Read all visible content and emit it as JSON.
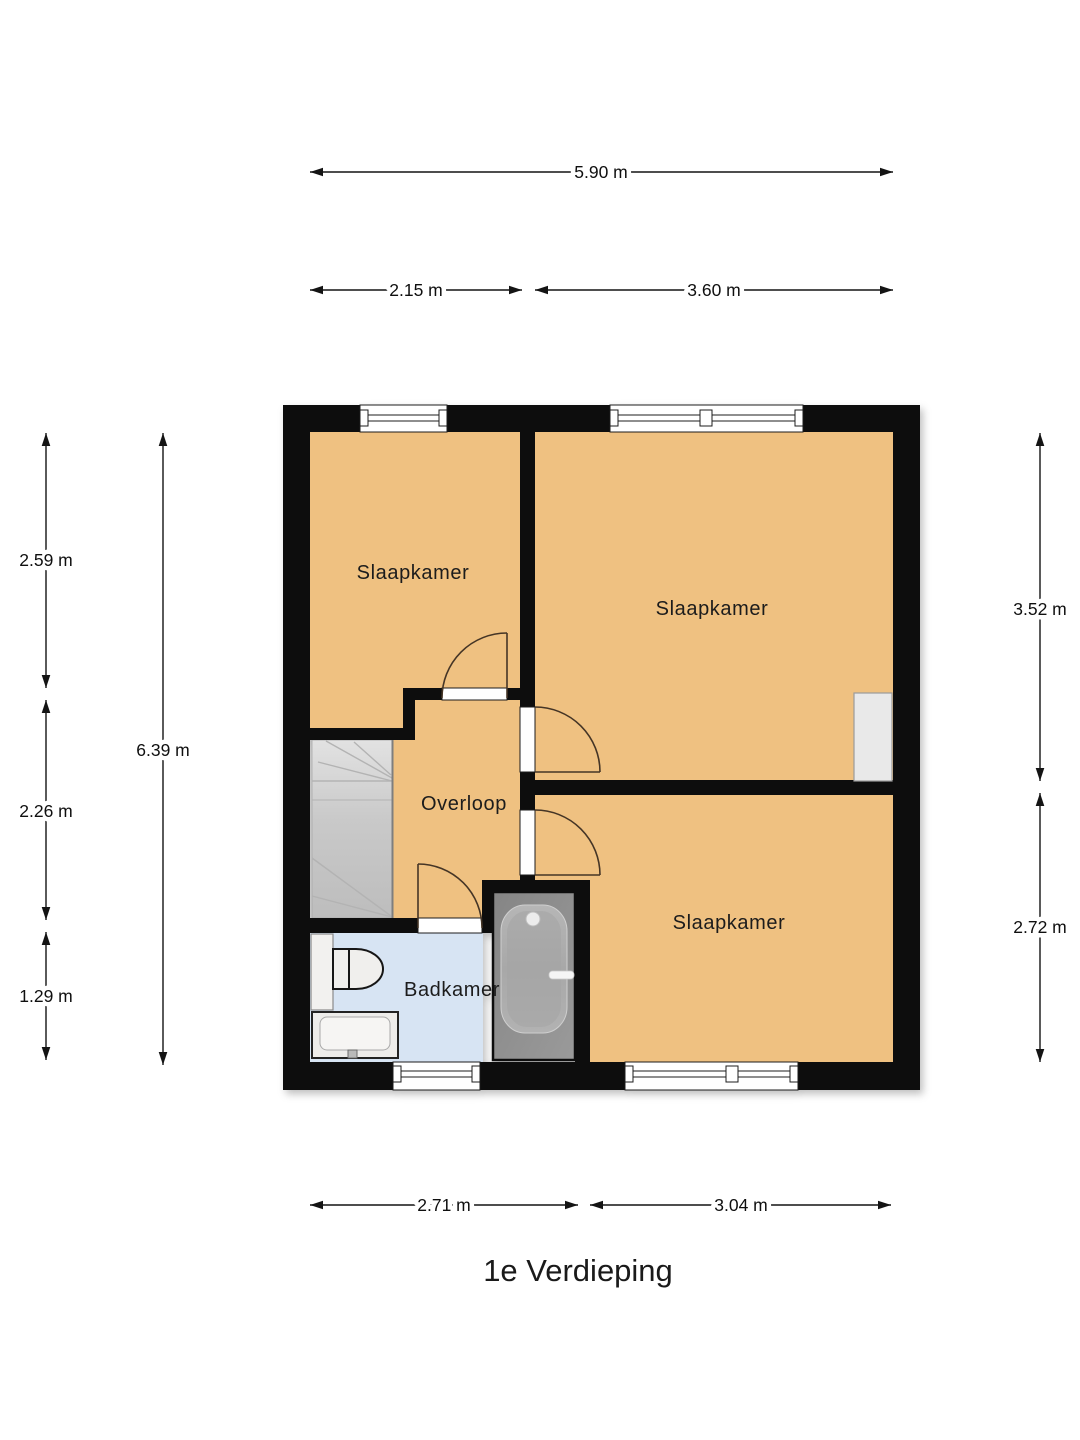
{
  "title": "1e Verdieping",
  "rooms": {
    "bedroom_top_left": {
      "label": "Slaapkamer"
    },
    "bedroom_top_right": {
      "label": "Slaapkamer"
    },
    "bedroom_bottom_right": {
      "label": "Slaapkamer"
    },
    "landing": {
      "label": "Overloop"
    },
    "bathroom": {
      "label": "Badkamer"
    }
  },
  "dimensions": {
    "top_total": "5.90 m",
    "top_left_width": "2.15 m",
    "top_right_width": "3.60 m",
    "left_upper": "2.59 m",
    "left_middle": "2.26 m",
    "left_lower": "1.29 m",
    "left_total": "6.39 m",
    "right_upper": "3.52 m",
    "right_lower": "2.72 m",
    "bottom_left_width": "2.71 m",
    "bottom_right_width": "3.04 m"
  },
  "fixtures": [
    "stairs",
    "bathtub",
    "toilet",
    "sink",
    "vanity-cabinet",
    "wall-recess"
  ],
  "colors": {
    "background": "#ffffff",
    "room_fill": "#efc181",
    "bathroom_fill": "#d7e4f3",
    "stairs_fill": "#cccccc",
    "wall": "#0d0d0d",
    "door_arc": "#453525",
    "dimension_line": "#141414",
    "text": "#1c1c1c"
  }
}
